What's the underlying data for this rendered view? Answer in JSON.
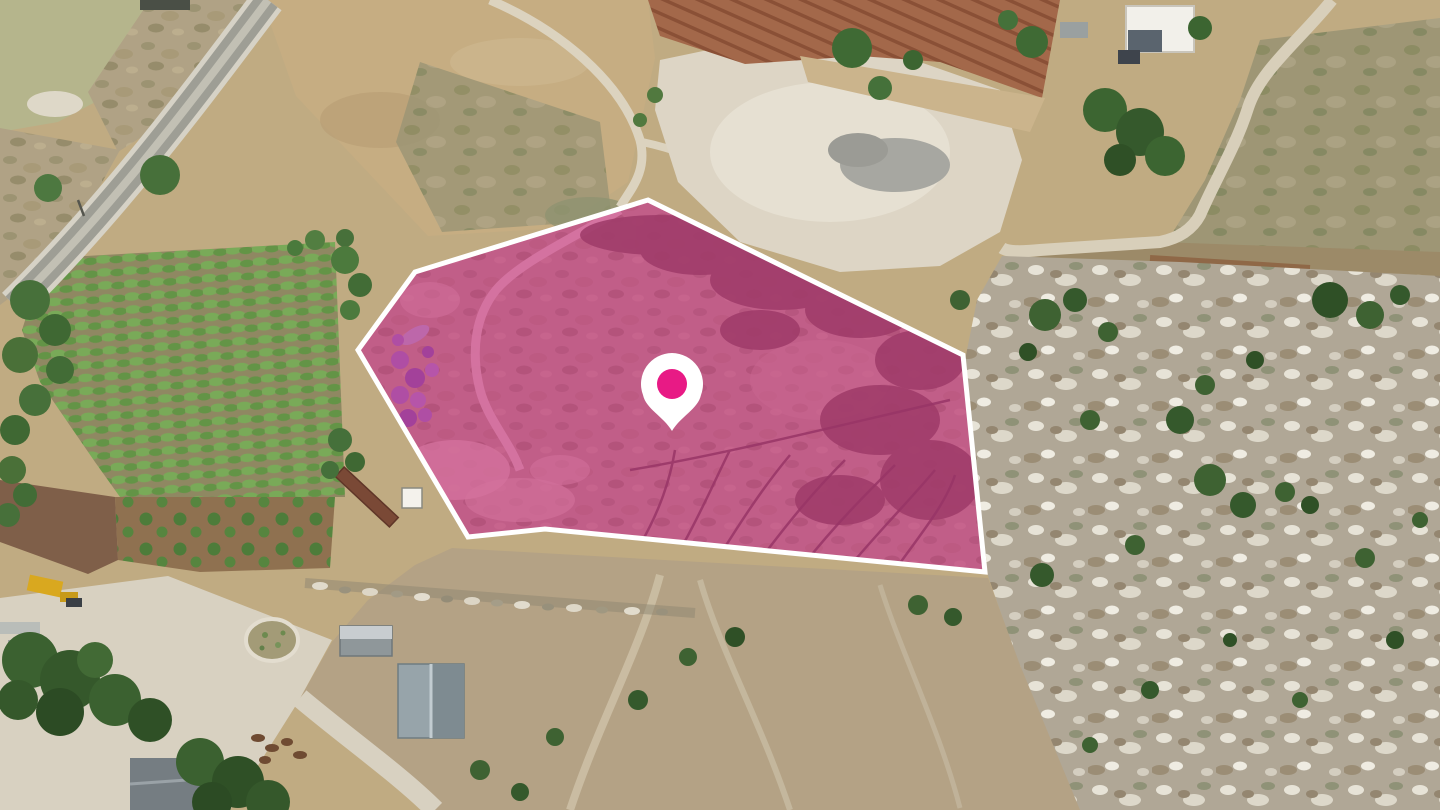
{
  "map": {
    "parcel_overlay": {
      "points": "648,200 963,355 985,572 545,529 468,537 358,350 415,272",
      "fill": "#d11a8c",
      "opacity": "0.5",
      "stroke": "#ffffff",
      "stroke_width": "5"
    },
    "marker": {
      "halo": "#ffffff",
      "path": "M672,431 C663,416 646,409 643,395 A31,31 0 1 1 701,395 C698,409 681,416 672,431 Z",
      "dot": "#e81a85",
      "dot_cx": "672",
      "dot_cy": "384",
      "dot_r": "15"
    }
  }
}
